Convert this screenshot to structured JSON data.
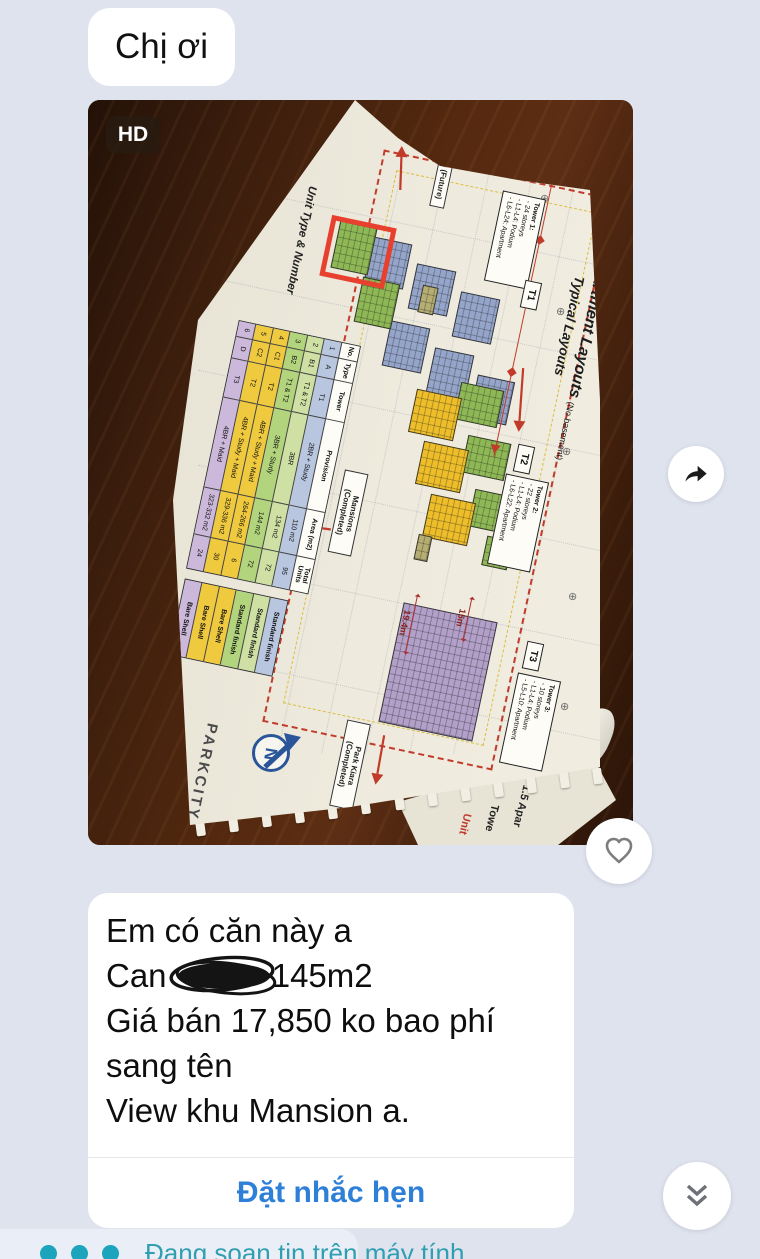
{
  "colors": {
    "background": "#dfe3ee",
    "bubble": "#ffffff",
    "action_blue": "#2e7fd8",
    "typing_teal": "#2f9fb1",
    "wood_brown": "#4a240f",
    "paper_cream": "#eeeadd",
    "red_accent": "#c23b2a",
    "highlight_red": "#e8402e"
  },
  "chat": {
    "greeting_text": "Chị ơi",
    "typing_text": "Đang soạn tin trên máy tính",
    "photo": {
      "hd_badge": "HD",
      "document": {
        "title_number": "1.5",
        "title": "Apartment Layouts",
        "title_note": "(No basement)",
        "subtitle": "Typical Layouts",
        "side_label": "Unit Type & Number",
        "brand": "PARKCITY",
        "compass_letter": "N",
        "tower_boxes": [
          {
            "tag": "T1",
            "title": "Tower 1:",
            "lines": [
              "24 storeys",
              "L1-L4: Podium",
              "L6-L24: Apartment"
            ]
          },
          {
            "tag": "T2",
            "title": "Tower 2:",
            "lines": [
              "22 storeys",
              "L1-L4: Podium",
              "L6-L22: Apartment"
            ]
          },
          {
            "tag": "T3",
            "title": "Tower 3:",
            "lines": [
              "10 storeys",
              "L1-L4: Podium",
              "L5-L10: Apartment"
            ]
          }
        ],
        "area_labels": {
          "hh08": "HH-08 (Future)",
          "mansions": "Mansions (Completed)",
          "park_kiara": "Park Kiara (Completed)"
        },
        "dimensions": {
          "d1": "19.4m",
          "d2": "15m"
        },
        "table": {
          "headers": [
            "No.",
            "Type",
            "Tower",
            "Provision",
            "Area (m2)",
            "Total Units"
          ],
          "rows": [
            {
              "no": "1",
              "type": "A",
              "tower": "T1",
              "provision": "2BR + Study",
              "area": "110 m2",
              "units": "95",
              "finish": "Standard finish",
              "color": "#b9c6e0"
            },
            {
              "no": "2",
              "type": "B1",
              "tower": "T1 & T2",
              "provision": "3BR",
              "area": "134 m2",
              "units": "72",
              "finish": "Standard finish",
              "color": "#cfe0a4"
            },
            {
              "no": "3",
              "type": "B2",
              "tower": "T1 & T2",
              "provision": "3BR + Study",
              "area": "144 m2",
              "units": "72",
              "finish": "Standard finish",
              "color": "#b2d47c"
            },
            {
              "no": "4",
              "type": "C1",
              "tower": "T2",
              "provision": "4BR + Study + Maid",
              "area": "264-266 m2",
              "units": "6",
              "finish": "Bare Shell",
              "color": "#f0ca3e"
            },
            {
              "no": "5",
              "type": "C2",
              "tower": "T2",
              "provision": "4BR + Study + Maid",
              "area": "329-336 m2",
              "units": "30",
              "finish": "Bare Shell",
              "color": "#f0ca3e"
            },
            {
              "no": "6",
              "type": "D",
              "tower": "T3",
              "provision": "4BR + Maid",
              "area": "323-332 m2",
              "units": "24",
              "finish": "Bare Shell",
              "color": "#cbb8da"
            }
          ]
        },
        "next_page_peek": {
          "line1": "1.5 Apar",
          "line2": "Towe",
          "line3": "Unit"
        }
      }
    },
    "listing": {
      "line1": "Em có căn này a",
      "line2_prefix": "Can ",
      "line2_suffix": "145m2",
      "line3": "Giá bán 17,850 ko bao phí",
      "line4": "sang tên",
      "line5": "View khu Mansion a.",
      "action_label": "Đặt nhắc hẹn"
    }
  },
  "icons": {
    "share": "forward-arrow",
    "heart": "heart-outline",
    "scroll": "double-chevron-down",
    "typing": "three-dots",
    "compass": "north-arrow",
    "redaction": "scribble"
  }
}
